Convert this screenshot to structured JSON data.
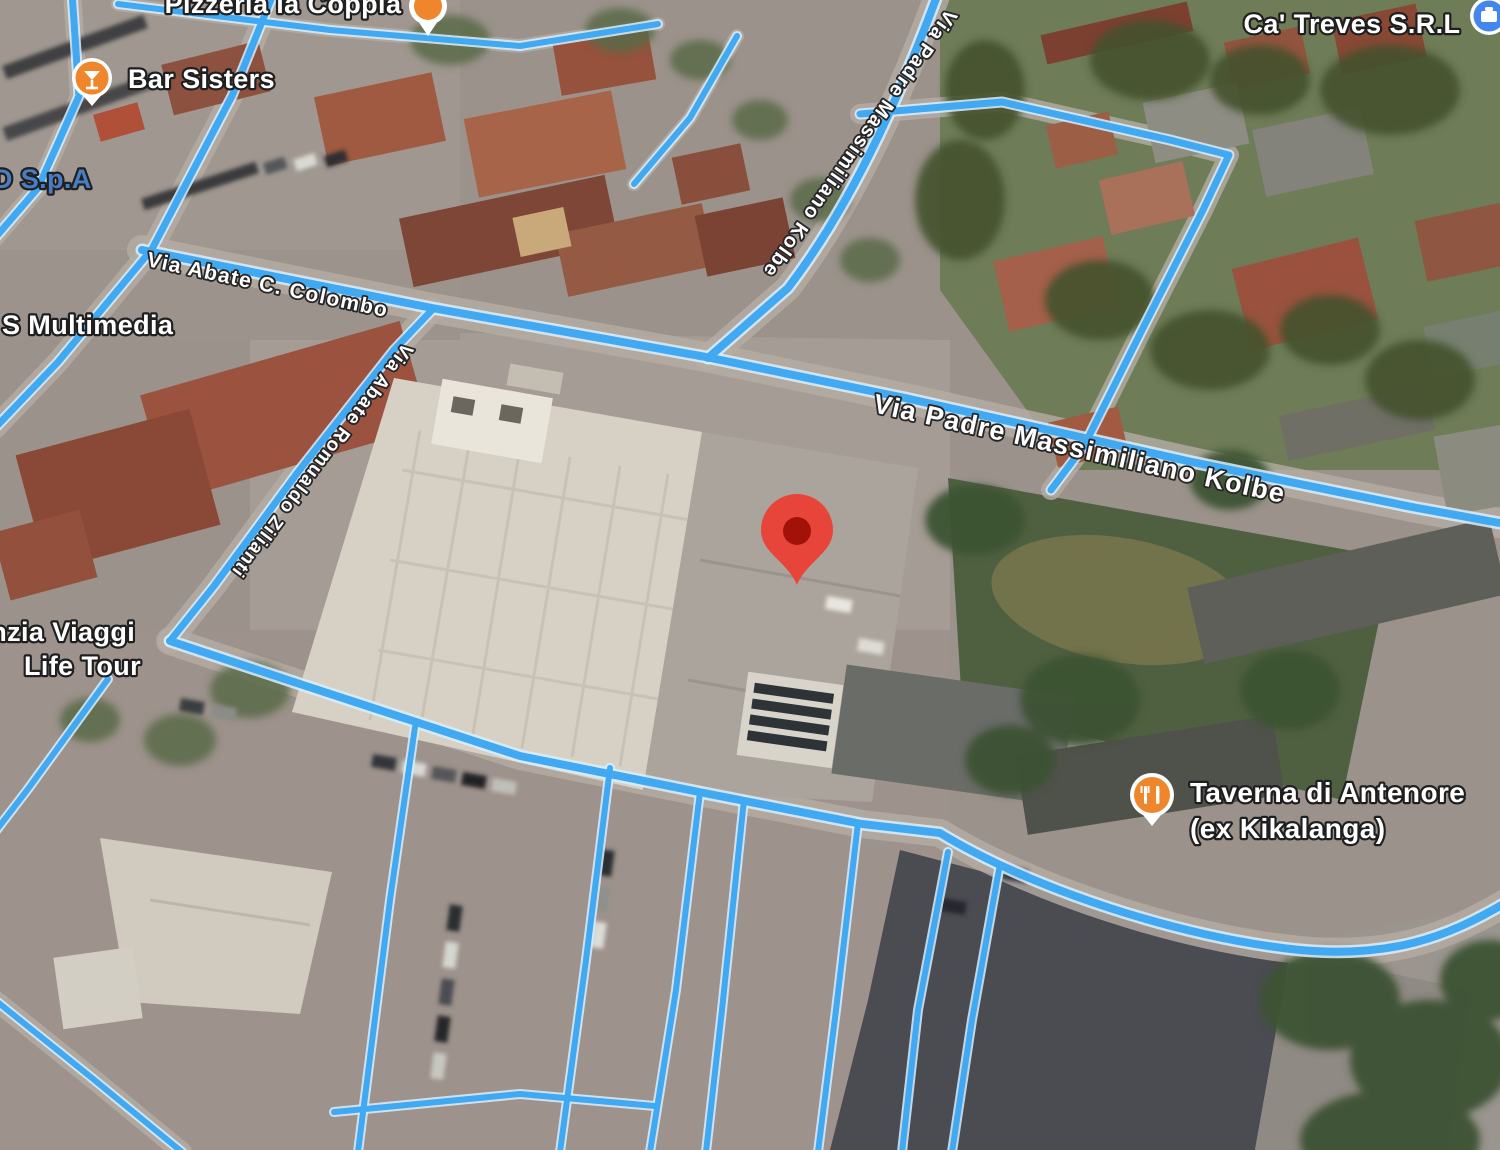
{
  "map": {
    "view_type": "satellite",
    "colors": {
      "route": "#41A8F2",
      "route_halo": "#D8EFFD",
      "label_fill": "#FFFFFF",
      "label_outline": "#1F1F1F",
      "md_label_fill": "#4A7CC4",
      "marker_red": "#E8453A",
      "marker_inner_red": "#A31208",
      "poi_icon_orange": "#F0862B",
      "poi_icon_blue": "#4486F0"
    },
    "marker": {
      "name": "dropped-pin"
    },
    "poi": [
      {
        "label": "Pizzeria la Coppia",
        "icon": "orange-place-pin"
      },
      {
        "label": "Bar Sisters",
        "icon": "cocktail"
      },
      {
        "label": "Ca' Treves S.R.L",
        "icon": "business"
      },
      {
        "label": "MD S.p.A",
        "icon": "none"
      },
      {
        "label": "S Multimedia",
        "icon": "none"
      },
      {
        "label_line1": "Agenzia Viaggi",
        "label_line2": "Life Tour",
        "icon": "none"
      },
      {
        "label_line1": "Taverna di Antenore",
        "label_line2": "(ex Kikalanga)",
        "icon": "restaurant"
      }
    ],
    "streets": [
      {
        "name": "Via Abate C. Colombo"
      },
      {
        "name": "Via Padre Massimiliano Kolbe"
      },
      {
        "name": "Via Padre Massimiliano Kolbe"
      },
      {
        "name": "Via Abate Romualdo Zilianti"
      }
    ]
  }
}
